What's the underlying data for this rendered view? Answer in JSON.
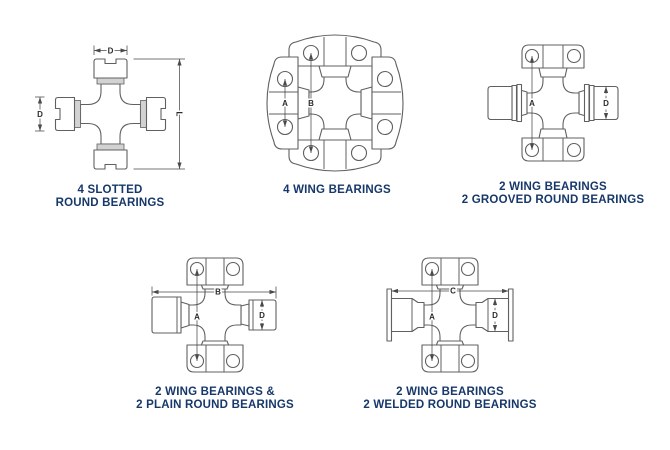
{
  "colors": {
    "background": "#ffffff",
    "outline": "#5f6062",
    "dim_line": "#4a4a4b",
    "dim_label": "#2b2b2c",
    "caption_text": "#17386a",
    "shade_fill": "#d2d2d3"
  },
  "diagrams": [
    {
      "id": "4-slotted-round-bearings",
      "caption_line1": "4 SLOTTED",
      "caption_line2": "ROUND BEARINGS",
      "labels": {
        "d_top": "D",
        "d_left": "D",
        "l_right": "L"
      }
    },
    {
      "id": "4-wing-bearings",
      "caption_line1": "4 WING BEARINGS",
      "caption_line2": "",
      "labels": {
        "a": "A",
        "b": "B"
      }
    },
    {
      "id": "2-wing-2-grooved-round-bearings",
      "caption_line1": "2 WING BEARINGS",
      "caption_line2": "2 GROOVED ROUND BEARINGS",
      "labels": {
        "a": "A",
        "d": "D"
      }
    },
    {
      "id": "2-wing-2-plain-round-bearings",
      "caption_line1": "2 WING BEARINGS &",
      "caption_line2": "2 PLAIN ROUND BEARINGS",
      "labels": {
        "a": "A",
        "b": "B",
        "d": "D"
      }
    },
    {
      "id": "2-wing-2-welded-round-bearings",
      "caption_line1": "2 WING BEARINGS",
      "caption_line2": "2 WELDED ROUND BEARINGS",
      "labels": {
        "a": "A",
        "c": "C",
        "d": "D"
      }
    }
  ]
}
